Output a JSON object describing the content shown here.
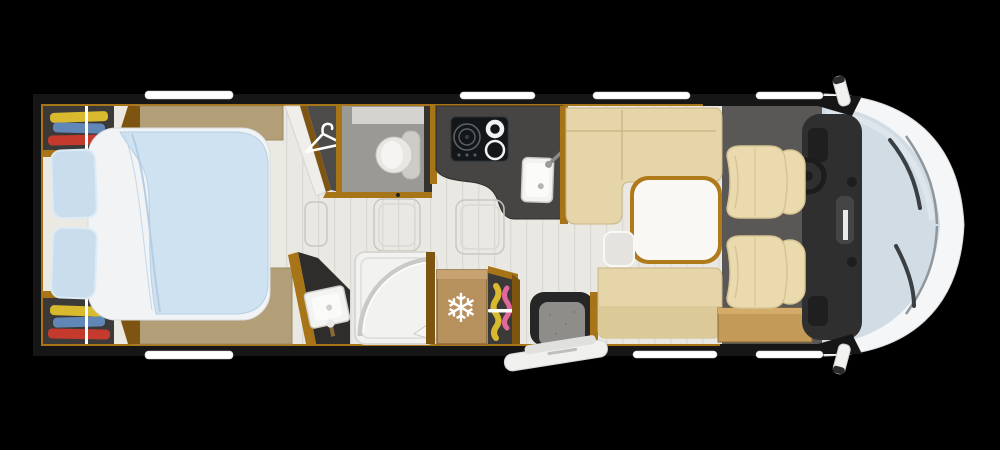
{
  "scene": {
    "kind": "motorhome-floorplan-top-view",
    "background": "#000000"
  },
  "icons": {
    "hanger": {
      "name": "hanger-icon"
    },
    "snowflake": {
      "name": "snowflake-icon",
      "glyph": "❄"
    }
  },
  "colors": {
    "wall": "#161616",
    "wood": "#a87418",
    "wood_dark": "#7e5510",
    "floor": "#e9e8e3",
    "bedroom_floor": "#ece9e2",
    "bedroom_tan": "#b29e77",
    "wardrobe_dark": "#3b3a38",
    "clothes_yellow": "#d9ba2e",
    "clothes_blue": "#6187b6",
    "clothes_red": "#c43a2d",
    "clothes_pink": "#e4679c",
    "rail_white": "#ffffff",
    "bed_sheet": "#f1f3f5",
    "bed_duvet": "#cfe2f1",
    "duvet_shadow": "#b4cde2",
    "pillow": "#c9dded",
    "panel_white": "#efeeea",
    "hanger_floor": "#4c4b49",
    "toilet_floor": "#9b9995",
    "toilet_bowl": "#e9e7e3",
    "toilet_tank": "#cfccc8",
    "counter": "#474543",
    "hob": "#14171a",
    "hob_ring": "#5c6166",
    "burner_white": "#f2f2f2",
    "sink": "#f3f3f1",
    "basin_counter": "#2e2d2b",
    "shower_tray": "#f2f2f0",
    "shower_glass": "#c9c9c5",
    "fridge": "#b6905d",
    "snowflake_white": "#ffffff",
    "step_frame": "#262626",
    "step_floor": "#8e8d8a",
    "door_leaf": "#f0f0ee",
    "sofa": "#e6d5a9",
    "sofa_seam": "#cdb985",
    "sofa_back": "#dbc997",
    "table_rim": "#b07a1b",
    "table_top": "#faf8f4",
    "leaf_gray": "#e4e3df",
    "cabinet_tan": "#c49a58",
    "cab_floor": "#5a5856",
    "seat": "#eadaae",
    "seat_seam": "#d8c592",
    "dashboard": "#2f2f2f",
    "dash_detail": "#454545",
    "steering": "#1c1c1c",
    "windshield": "#d1dce4",
    "glass_chrome": "#8f979d",
    "wiper": "#3a3f43",
    "body_white": "#f5f6f7",
    "mirror_white": "#f2f2f0",
    "window_white": "#ffffff"
  }
}
